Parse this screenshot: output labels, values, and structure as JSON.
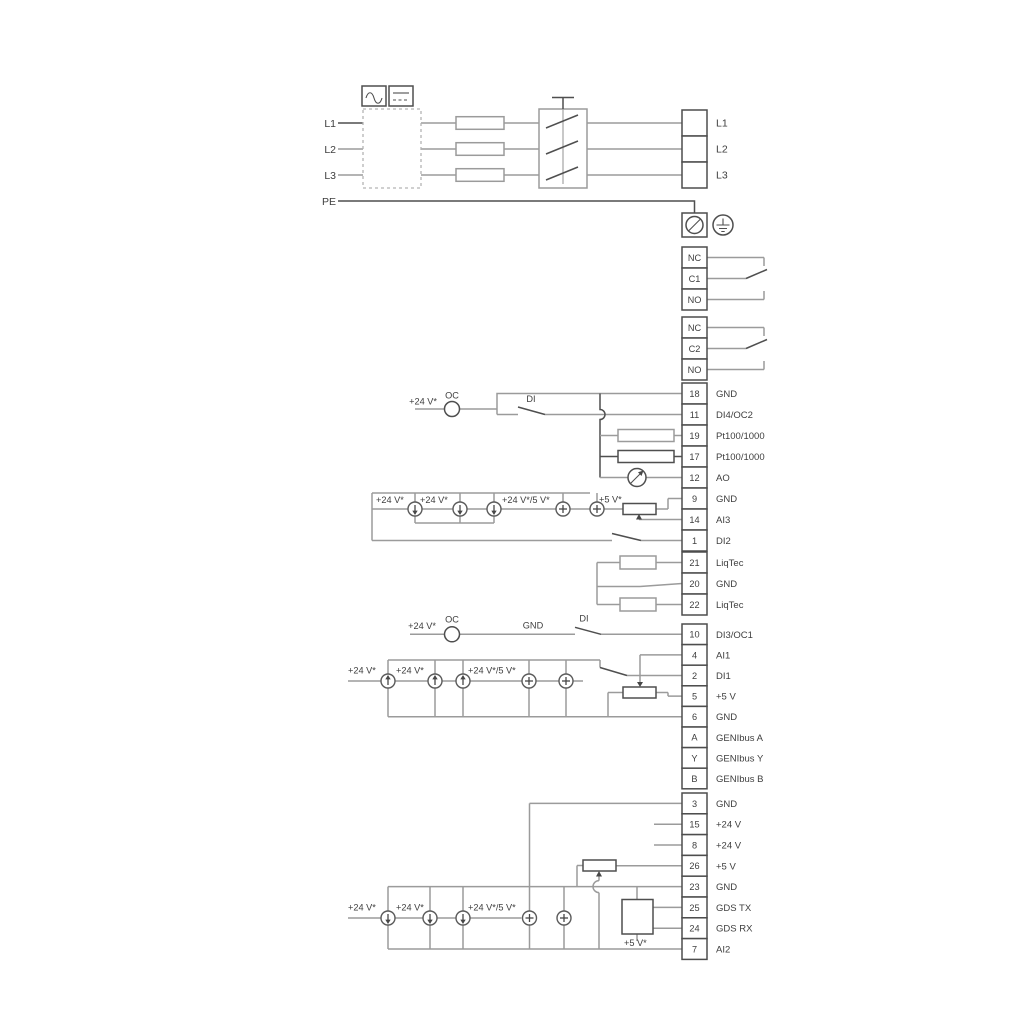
{
  "power": {
    "left_labels": [
      "L1",
      "L2",
      "L3",
      "PE"
    ],
    "output_labels": [
      "L1",
      "L2",
      "L3"
    ]
  },
  "icons": {
    "ac": "ac-wave",
    "dc": "dc-line",
    "ground_terminal": "ground-slash",
    "earth": "protective-earth",
    "analog_output": "meter-dial"
  },
  "relays": {
    "relay1": [
      "NC",
      "C1",
      "NO"
    ],
    "relay2": [
      "NC",
      "C2",
      "NO"
    ]
  },
  "terminals": {
    "io1": [
      {
        "pin": "18",
        "label": "GND"
      },
      {
        "pin": "11",
        "label": "DI4/OC2"
      },
      {
        "pin": "19",
        "label": "Pt100/1000"
      },
      {
        "pin": "17",
        "label": "Pt100/1000"
      },
      {
        "pin": "12",
        "label": "AO"
      },
      {
        "pin": "9",
        "label": "GND"
      },
      {
        "pin": "14",
        "label": "AI3"
      },
      {
        "pin": "1",
        "label": "DI2"
      }
    ],
    "liqtec": [
      {
        "pin": "21",
        "label": "LiqTec"
      },
      {
        "pin": "20",
        "label": "GND"
      },
      {
        "pin": "22",
        "label": "LiqTec"
      }
    ],
    "io2": [
      {
        "pin": "10",
        "label": "DI3/OC1"
      },
      {
        "pin": "4",
        "label": "AI1"
      },
      {
        "pin": "2",
        "label": "DI1"
      },
      {
        "pin": "5",
        "label": "+5 V"
      },
      {
        "pin": "6",
        "label": "GND"
      },
      {
        "pin": "A",
        "label": "GENIbus A"
      },
      {
        "pin": "Y",
        "label": "GENIbus Y"
      },
      {
        "pin": "B",
        "label": "GENIbus B"
      }
    ],
    "io3": [
      {
        "pin": "3",
        "label": "GND"
      },
      {
        "pin": "15",
        "label": "+24 V"
      },
      {
        "pin": "8",
        "label": "+24 V"
      },
      {
        "pin": "26",
        "label": "+5 V"
      },
      {
        "pin": "23",
        "label": "GND"
      },
      {
        "pin": "25",
        "label": "GDS TX"
      },
      {
        "pin": "24",
        "label": "GDS RX"
      },
      {
        "pin": "7",
        "label": "AI2"
      }
    ]
  },
  "annotations": {
    "v24": "+24 V*",
    "v24_5": "+24 V*/5 V*",
    "v5": "+5 V*",
    "oc": "OC",
    "di": "DI",
    "gnd": "GND"
  }
}
